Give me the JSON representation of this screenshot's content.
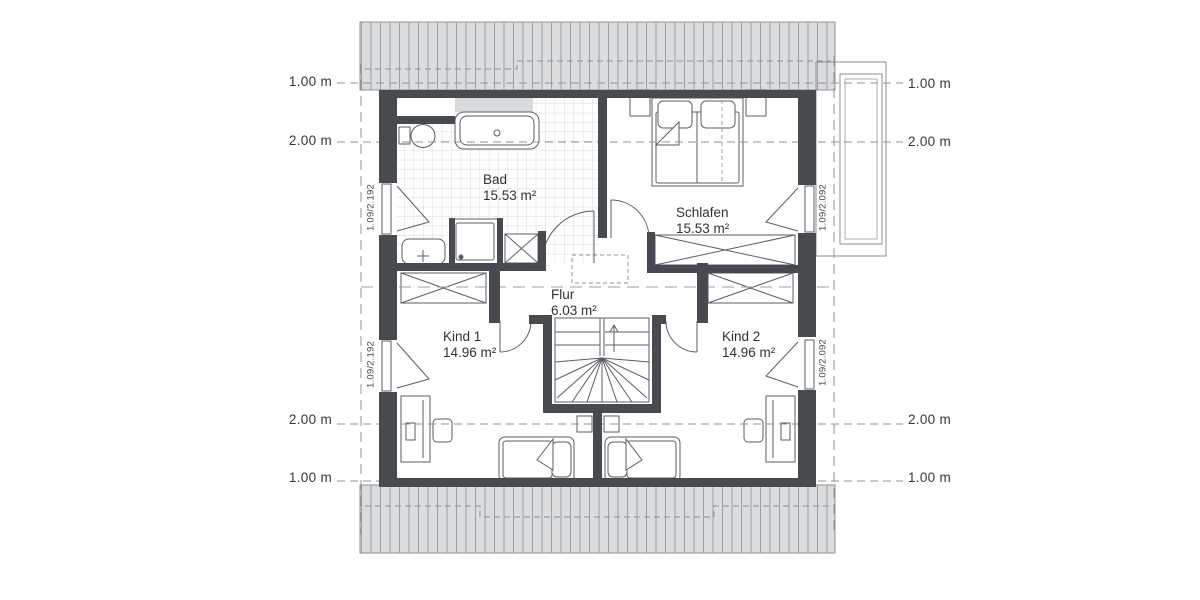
{
  "rooms": {
    "bad": {
      "name": "Bad",
      "area": "15.53 m²"
    },
    "schlafen": {
      "name": "Schlafen",
      "area": "15.53 m²"
    },
    "flur": {
      "name": "Flur",
      "area": "6.03 m²"
    },
    "kind1": {
      "name": "Kind 1",
      "area": "14.96 m²"
    },
    "kind2": {
      "name": "Kind 2",
      "area": "14.96 m²"
    }
  },
  "height_lines": {
    "left": [
      "1.00 m",
      "2.00 m",
      "2.00 m",
      "1.00 m"
    ],
    "right": [
      "1.00 m",
      "2.00 m",
      "2.00 m",
      "1.00 m"
    ]
  },
  "windows": {
    "left_top": "1.09/2.192",
    "left_bottom": "1.09/2.192",
    "right_top": "1.09/2.092",
    "right_bottom": "1.09/2.092"
  },
  "colors": {
    "wall": "#474b50",
    "roof_fill": "#dbdcdd",
    "roof_line": "#9ba0a4",
    "guide": "#8e959a",
    "text": "#33373b"
  }
}
